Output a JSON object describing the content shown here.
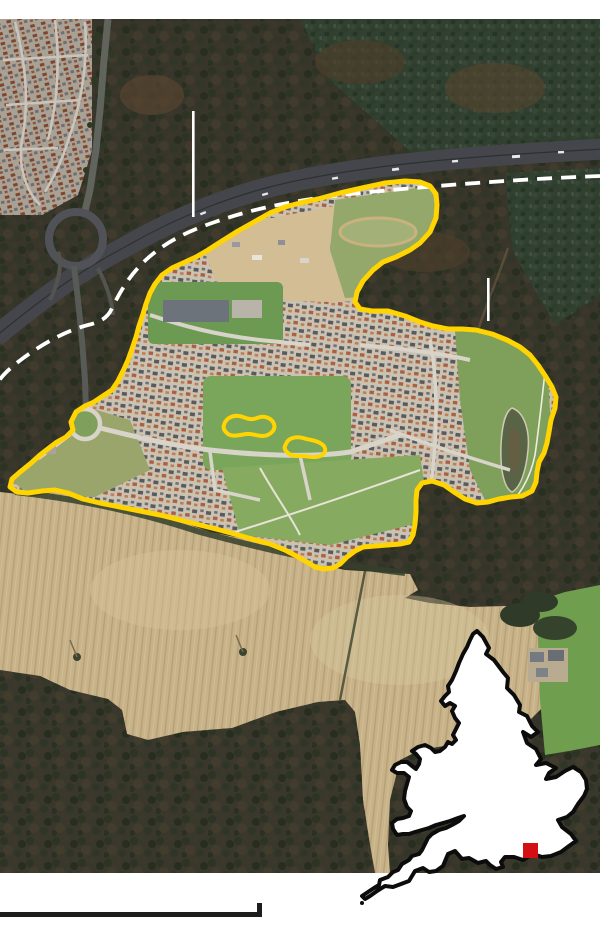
{
  "page": {
    "background": "#ffffff",
    "kind": "annotated-aerial-photo-graphic"
  },
  "map": {
    "overlays": {
      "site_boundary": {
        "color": "#ffd400",
        "style": "solid",
        "shape": "irregular-polygon"
      },
      "excluded_loops": {
        "color": "#ffd400",
        "count": 2
      },
      "dashed_route": {
        "color": "#ffffff",
        "style": "dashed"
      },
      "leader_line_1": {
        "color": "#ffffff"
      },
      "leader_line_2": {
        "color": "#ffffff"
      }
    },
    "terrain": {
      "woodland": "#38352a",
      "conifer": "#31402f",
      "field": "#c7b289",
      "pasture": "#6f9e4f",
      "development_base": "#c9c2b1",
      "grass": "#7aa65b",
      "motorway": "#45464b",
      "sand_construction": "#d3bd95"
    },
    "inset": {
      "region": "england-outline",
      "fill": "#ffffff",
      "stroke": "#0c0c0c",
      "marker": {
        "shape": "square",
        "color": "#d40f14"
      }
    },
    "scale_bar": {
      "color": "#1d1d1b"
    }
  }
}
